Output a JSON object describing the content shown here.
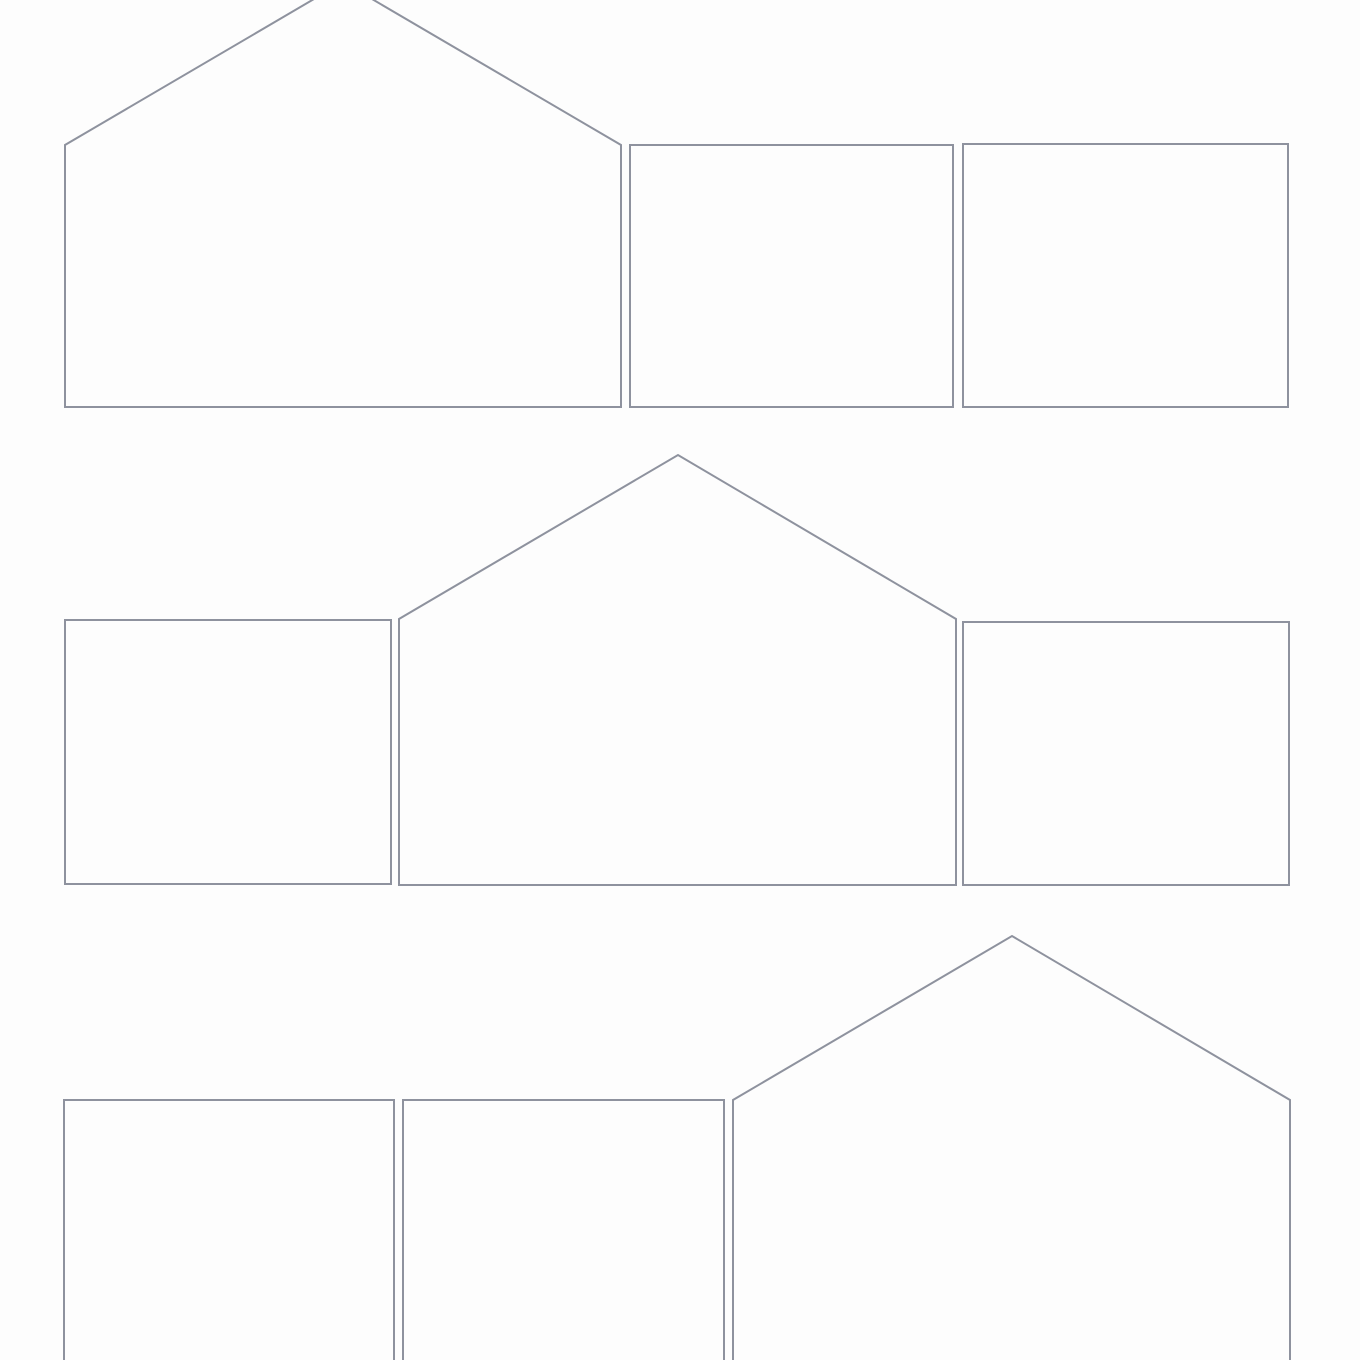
{
  "canvas": {
    "width": 1360,
    "height": 1360,
    "background_color": "#fdfdfd"
  },
  "stroke": {
    "color": "#8e929e",
    "width": 2
  },
  "rows": [
    {
      "name": "row-1",
      "shapes": [
        {
          "name": "house-pentagon-outline-row1",
          "kind": "house-pentagon",
          "clipped_edge": "top",
          "points": [
            [
              65,
              407
            ],
            [
              65,
              145
            ],
            [
              343,
              -18
            ],
            [
              621,
              145
            ],
            [
              621,
              407
            ]
          ]
        },
        {
          "name": "rectangle-outline-row1-a",
          "kind": "rectangle",
          "points": [
            [
              630,
              145
            ],
            [
              953,
              145
            ],
            [
              953,
              407
            ],
            [
              630,
              407
            ]
          ]
        },
        {
          "name": "rectangle-outline-row1-b",
          "kind": "rectangle",
          "points": [
            [
              963,
              144
            ],
            [
              1288,
              144
            ],
            [
              1288,
              407
            ],
            [
              963,
              407
            ]
          ]
        }
      ]
    },
    {
      "name": "row-2",
      "shapes": [
        {
          "name": "rectangle-outline-row2-a",
          "kind": "rectangle",
          "points": [
            [
              65,
              620
            ],
            [
              391,
              620
            ],
            [
              391,
              884
            ],
            [
              65,
              884
            ]
          ]
        },
        {
          "name": "house-pentagon-outline-row2",
          "kind": "house-pentagon",
          "points": [
            [
              399,
              885
            ],
            [
              399,
              619
            ],
            [
              678,
              455
            ],
            [
              956,
              619
            ],
            [
              956,
              885
            ]
          ]
        },
        {
          "name": "rectangle-outline-row2-b",
          "kind": "rectangle",
          "points": [
            [
              963,
              622
            ],
            [
              1289,
              622
            ],
            [
              1289,
              885
            ],
            [
              963,
              885
            ]
          ]
        }
      ]
    },
    {
      "name": "row-3",
      "shapes": [
        {
          "name": "rectangle-outline-row3-a",
          "kind": "rectangle",
          "clipped_edge": "bottom",
          "points": [
            [
              64,
              1100
            ],
            [
              394,
              1100
            ],
            [
              394,
              1372
            ],
            [
              64,
              1372
            ]
          ]
        },
        {
          "name": "rectangle-outline-row3-b",
          "kind": "rectangle",
          "clipped_edge": "bottom",
          "points": [
            [
              403,
              1100
            ],
            [
              724,
              1100
            ],
            [
              724,
              1372
            ],
            [
              403,
              1372
            ]
          ]
        },
        {
          "name": "house-pentagon-outline-row3",
          "kind": "house-pentagon",
          "clipped_edge": "bottom",
          "points": [
            [
              733,
              1372
            ],
            [
              733,
              1100
            ],
            [
              1012,
              936
            ],
            [
              1290,
              1100
            ],
            [
              1290,
              1372
            ]
          ]
        }
      ]
    }
  ]
}
